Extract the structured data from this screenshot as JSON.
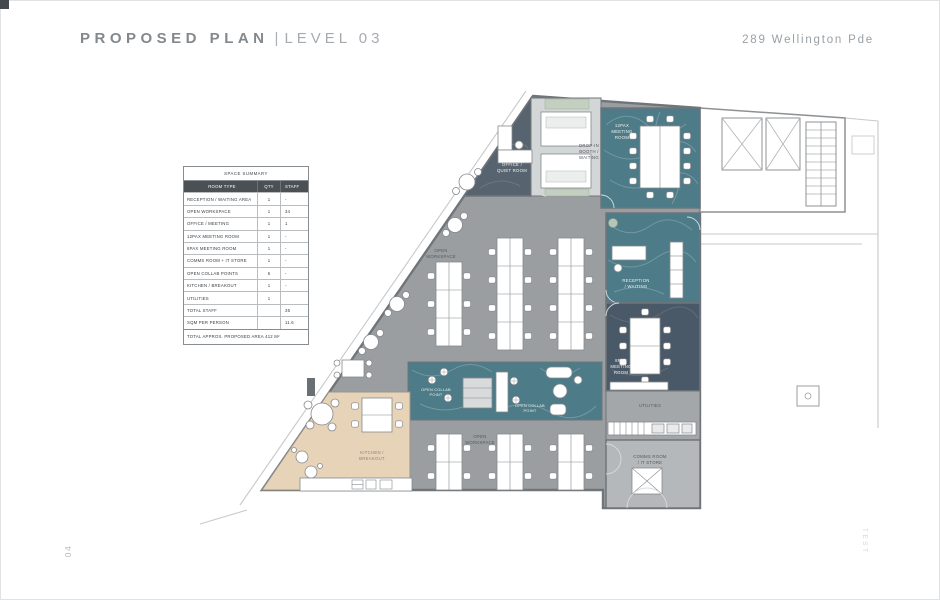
{
  "page": {
    "title_main": "PROPOSED PLAN",
    "title_sep": "|",
    "title_sub": "LEVEL 03",
    "address": "289 Wellington Pde",
    "page_number": "04",
    "side_mark": "TEST"
  },
  "summary_table": {
    "title": "SPACE SUMMARY",
    "columns": {
      "room_type": "ROOM TYPE",
      "qty": "QTY",
      "staff": "STAFF"
    },
    "rows": [
      {
        "room_type": "RECEPTION / WAITING AREA",
        "qty": "1",
        "staff": "-"
      },
      {
        "room_type": "OPEN WORKSPACE",
        "qty": "1",
        "staff": "34"
      },
      {
        "room_type": "OFFICE / MEETING",
        "qty": "1",
        "staff": "1"
      },
      {
        "room_type": "12PAX MEETING ROOM",
        "qty": "1",
        "staff": "-"
      },
      {
        "room_type": "8PAX MEETING ROOM",
        "qty": "1",
        "staff": "-"
      },
      {
        "room_type": "COMMS ROOM + IT STORE",
        "qty": "1",
        "staff": "-"
      },
      {
        "room_type": "OPEN COLLAB POINTS",
        "qty": "6",
        "staff": "-"
      },
      {
        "room_type": "KITCHEN / BREAKOUT",
        "qty": "1",
        "staff": "-"
      },
      {
        "room_type": "UTILITIES",
        "qty": "1",
        "staff": ""
      },
      {
        "room_type": "TOTAL STAFF",
        "qty": "",
        "staff": "35"
      },
      {
        "room_type": "SQM PER PERSON",
        "qty": "",
        "staff": "11.6"
      }
    ],
    "footer": "TOTAL APPROX.  PROPOSED AREA  412 M²"
  },
  "plan": {
    "labels": {
      "office_1": "OFFICE /",
      "office_2": "QUIET ROOM",
      "booth_1": "DROP-IN",
      "booth_2": "BOOTH /",
      "booth_3": "WAITING",
      "meeting12_1": "12PAX",
      "meeting12_2": "MEETING",
      "meeting12_3": "ROOM",
      "workspace_upper_1": "OPEN",
      "workspace_upper_2": "WORKSPACE",
      "reception_1": "RECEPTION",
      "reception_2": "/ WAITING",
      "meeting8_1": "8PAX",
      "meeting8_2": "MEETING",
      "meeting8_3": "ROOM",
      "utilities": "UTILITIES",
      "comms_1": "COMMS ROOM",
      "comms_2": "/ IT STORE",
      "collab_left_1": "OPEN COLLAB",
      "collab_left_2": "POINT",
      "collab_mid_1": "OPEN COLLAB",
      "collab_mid_2": "POINT",
      "kitchen_1": "KITCHEN /",
      "kitchen_2": "BREAKOUT",
      "workspace_lower_1": "OPEN",
      "workspace_lower_2": "WORKSPACE"
    },
    "colors": {
      "carpet": "#9b9ea1",
      "teal": "#4d7b87",
      "dark_room": "#57646f",
      "meeting8_room": "#4a5967",
      "timber": "#e7d4b8",
      "utility_floor": "#a4a7aa",
      "comms_floor": "#b5b8ba",
      "booth_floor": "#d3d6d7",
      "wall": "#70757a"
    }
  }
}
